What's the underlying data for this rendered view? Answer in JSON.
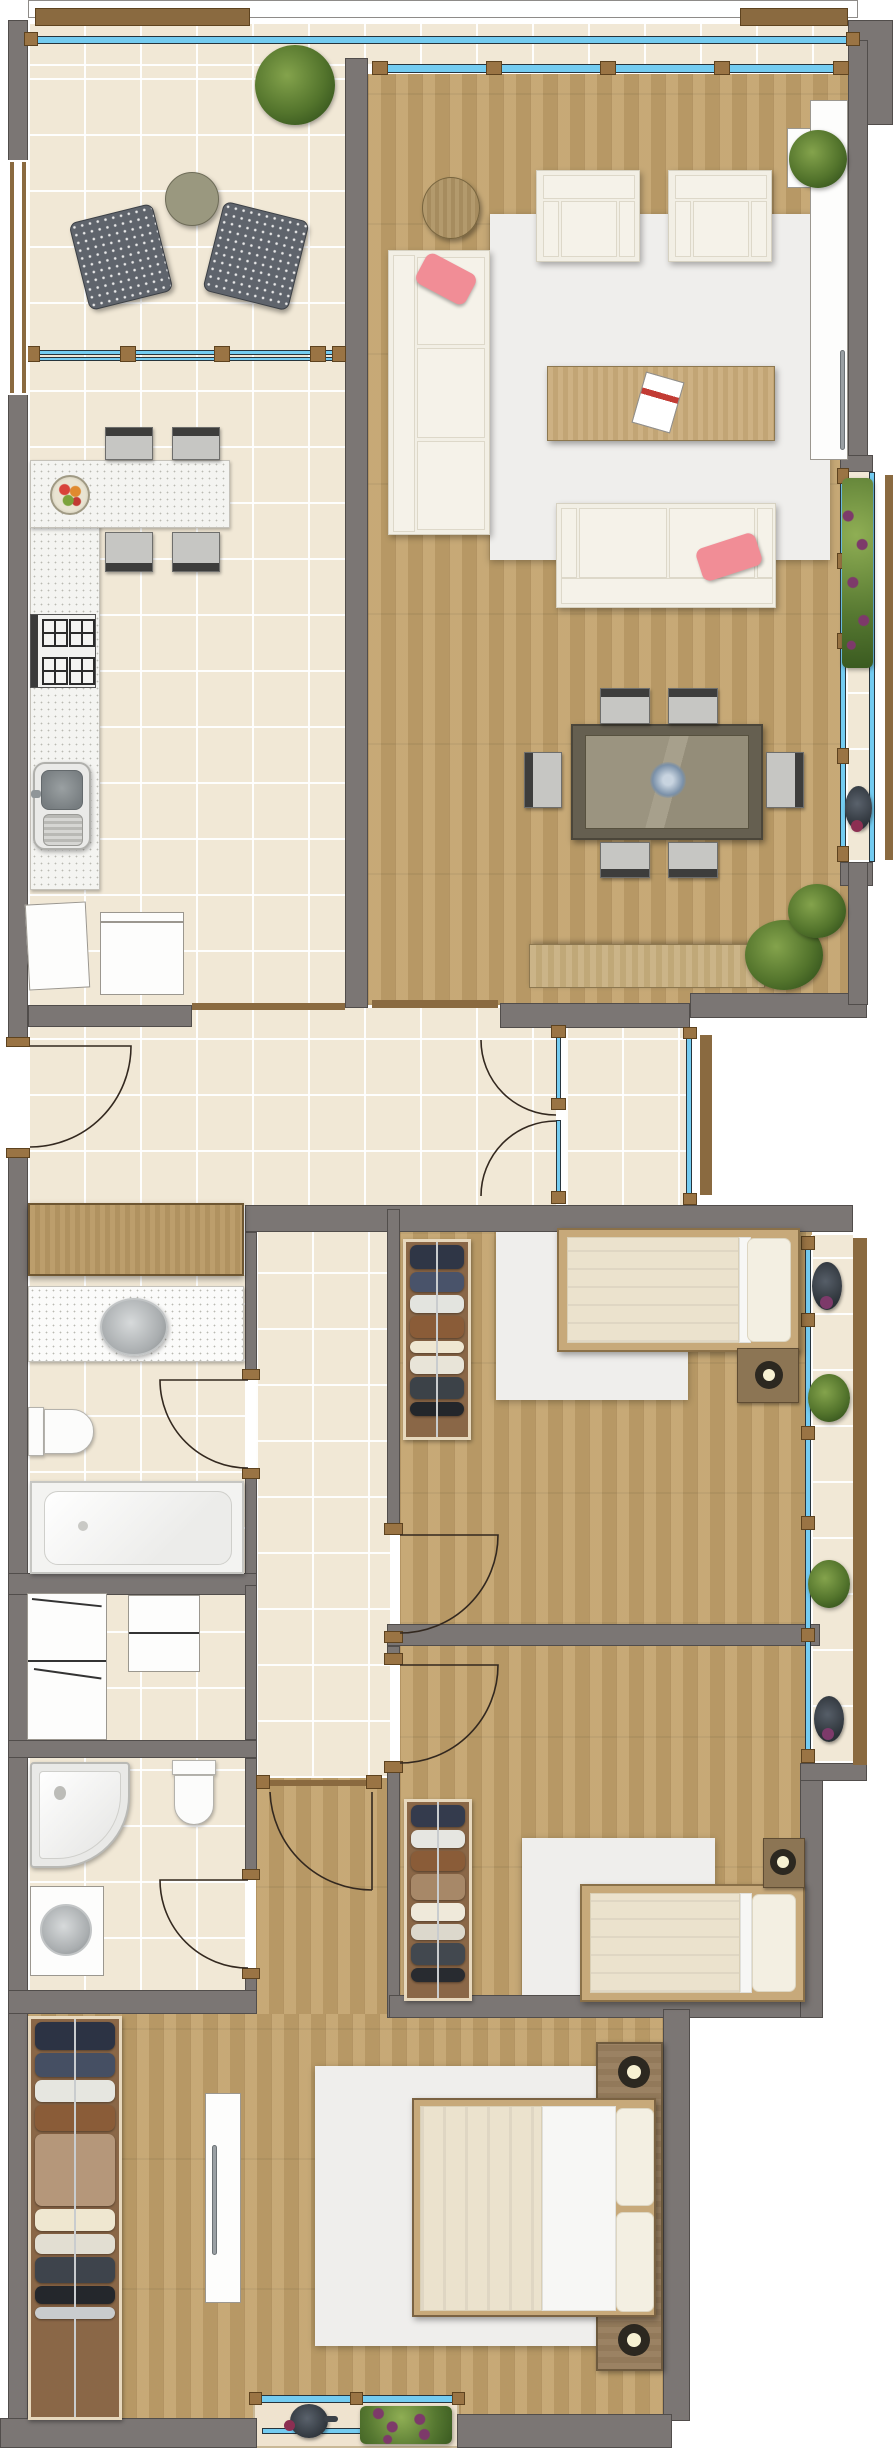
{
  "title": "apartment-floor-plan",
  "palette": {
    "wall": "#7b7674",
    "tile": "#f1e8d6",
    "wood": "#c2a26b",
    "glass": "#74ccf1",
    "frame_brown": "#9a7444",
    "accent_pink": "#f18d96",
    "cream": "#f2efe5",
    "plant_green": "#53742c",
    "flower_purple": "#7d3a6a"
  },
  "rooms": {
    "terrace": {
      "name": "Terrace",
      "floor": "tile",
      "furniture": [
        "round bistro table",
        "wicker chair",
        "wicker chair",
        "potted plant"
      ]
    },
    "living_room": {
      "name": "Living / Dining Room",
      "floor": "wood",
      "furniture": [
        "corner sofa with pink pillow",
        "two-seat sofa with pink pillow",
        "armchair",
        "armchair",
        "round side table",
        "coffee table with magazine",
        "area rug",
        "dining table with centerpiece",
        "six dining chairs",
        "sideboard",
        "corner plants",
        "wall shelf with plant",
        "media cabinet"
      ]
    },
    "kitchen": {
      "name": "Kitchen",
      "floor": "tile",
      "furniture": [
        "L-shaped counter",
        "fruit bowl",
        "four chairs",
        "cooktop",
        "double sink",
        "appliance",
        "appliance"
      ]
    },
    "hall": {
      "name": "Hall",
      "floor": "tile",
      "furniture": [
        "hall cabinet"
      ]
    },
    "entry": {
      "name": "Entry Vestibule",
      "floor": "tile",
      "furniture": [
        "glazed double door",
        "entrance door leaf"
      ]
    },
    "bathroom": {
      "name": "Bathroom",
      "floor": "tile",
      "furniture": [
        "vanity with basin",
        "toilet",
        "bathtub"
      ]
    },
    "wc": {
      "name": "Shower Room",
      "floor": "tile",
      "furniture": [
        "corner shower",
        "toilet",
        "washbasin cabinet"
      ]
    },
    "storage": {
      "name": "Storage Nook",
      "floor": "tile",
      "furniture": [
        "tall cabinet",
        "cabinet"
      ]
    },
    "corridor": {
      "name": "Corridor",
      "floor": "wood",
      "furniture": []
    },
    "bedroom_1": {
      "name": "Bedroom 1",
      "floor": "wood",
      "furniture": [
        "single bed",
        "nightstand with lamp",
        "wardrobe",
        "rug"
      ]
    },
    "bedroom_2": {
      "name": "Bedroom 2",
      "floor": "wood",
      "furniture": [
        "single bed",
        "nightstand with lamp",
        "wardrobe",
        "rug"
      ]
    },
    "master_bedroom": {
      "name": "Master Bedroom",
      "floor": "wood",
      "furniture": [
        "double bed",
        "headboard with twin nightstand lamps",
        "wardrobe",
        "tall dresser",
        "rug"
      ]
    },
    "balcony_right_living": {
      "name": "Living Room Balcony",
      "furniture": [
        "flower box",
        "kettle pot"
      ]
    },
    "balcony_right_bedrooms": {
      "name": "Bedroom Balcony",
      "furniture": [
        "flower pot",
        "plants"
      ]
    },
    "balcony_master": {
      "name": "Master Balcony",
      "furniture": [
        "flower box",
        "teapot"
      ]
    }
  },
  "doors": [
    "entrance-door",
    "french-door-upper",
    "french-door-lower",
    "bathroom-door",
    "shower-room-door",
    "bedroom1-door",
    "bedroom2-door",
    "corridor-door"
  ],
  "windows": [
    "terrace-railing-glazing",
    "living-glass-front",
    "kitchen-window",
    "living-balcony-glazing",
    "bedroom-window-column",
    "entry-sidelight",
    "master-balcony-window",
    "terrace-side-window"
  ],
  "wardrobes": {
    "bedroom1": {
      "clothes": [
        {
          "color": "#2f3646",
          "h": 24
        },
        {
          "color": "#49536a",
          "h": 20
        },
        {
          "color": "#e3e4df",
          "h": 18
        },
        {
          "color": "#8a5c38",
          "h": 22
        },
        {
          "color": "#efe7d2",
          "h": 12
        },
        {
          "color": "#e8e4d8",
          "h": 18
        },
        {
          "color": "#3c4248",
          "h": 22
        },
        {
          "color": "#23262b",
          "h": 14
        }
      ]
    },
    "bedroom2": {
      "clothes": [
        {
          "color": "#343b4d",
          "h": 22
        },
        {
          "color": "#e6e6e1",
          "h": 18
        },
        {
          "color": "#8a5c38",
          "h": 20
        },
        {
          "color": "#a78868",
          "h": 26
        },
        {
          "color": "#efe9da",
          "h": 18
        },
        {
          "color": "#dcd8cc",
          "h": 16
        },
        {
          "color": "#42484f",
          "h": 22
        },
        {
          "color": "#282b30",
          "h": 14
        }
      ]
    },
    "master": {
      "clothes": [
        {
          "color": "#2c3344",
          "h": 28
        },
        {
          "color": "#454f63",
          "h": 24
        },
        {
          "color": "#e6e6e0",
          "h": 22
        },
        {
          "color": "#8a5c38",
          "h": 26
        },
        {
          "color": "#b5977a",
          "h": 72
        },
        {
          "color": "#efe7d0",
          "h": 22
        },
        {
          "color": "#e2ded2",
          "h": 20
        },
        {
          "color": "#3e444c",
          "h": 26
        },
        {
          "color": "#24272c",
          "h": 18
        },
        {
          "color": "#c9ccce",
          "h": 12
        }
      ]
    }
  }
}
